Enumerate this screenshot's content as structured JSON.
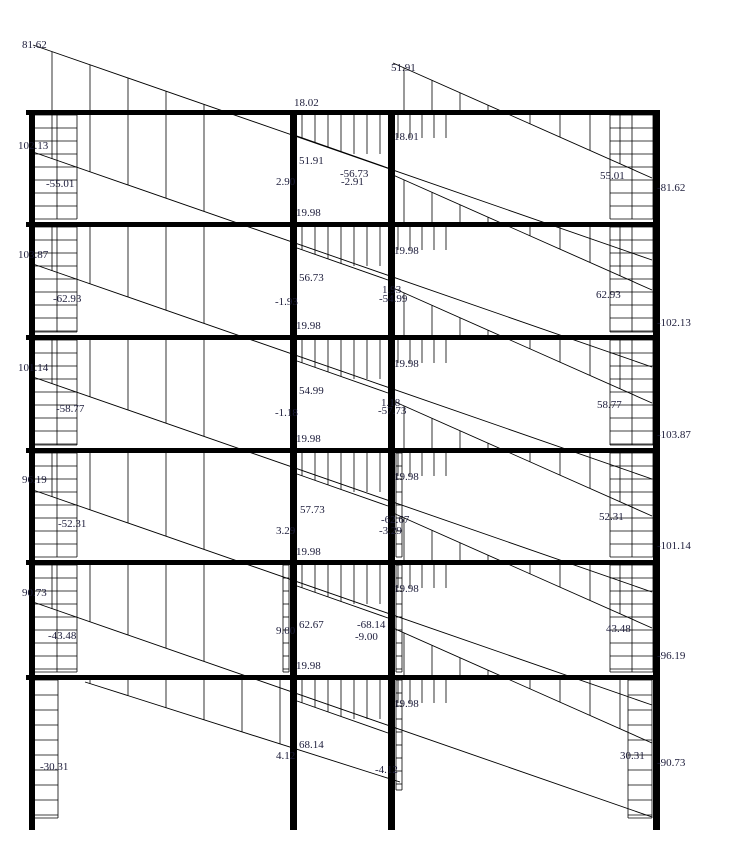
{
  "canvas": {
    "width": 729,
    "height": 867,
    "background": "#ffffff"
  },
  "colors": {
    "member": "#000000",
    "hatch": "#000000",
    "diagram_line": "#000000",
    "text": "#1c1c3a"
  },
  "figure_type": "frame-bending-moment-diagram",
  "frame": {
    "beams": {
      "ys": [
        110,
        222,
        335,
        448,
        560,
        675
      ],
      "x0": 26,
      "x1": 660,
      "thickness": 5
    },
    "columns": {
      "xs": [
        29,
        290,
        388,
        653
      ],
      "widths": [
        6,
        7,
        7,
        7
      ],
      "y0": 110,
      "y1": 830
    }
  },
  "story_tops": [
    110,
    222,
    335,
    448,
    560,
    675
  ],
  "diagram_lines": [
    {
      "id": "D0",
      "x0": 33,
      "y0": 45,
      "x1": 652,
      "y1": 260
    },
    {
      "id": "D1",
      "x0": 33,
      "y0": 152,
      "x1": 652,
      "y1": 367
    },
    {
      "id": "D2",
      "x0": 33,
      "y0": 264,
      "x1": 652,
      "y1": 479
    },
    {
      "id": "D3",
      "x0": 33,
      "y0": 377,
      "x1": 652,
      "y1": 592
    },
    {
      "id": "D4",
      "x0": 33,
      "y0": 490,
      "x1": 652,
      "y1": 705
    },
    {
      "id": "D5",
      "x0": 33,
      "y0": 602,
      "x1": 652,
      "y1": 817
    },
    {
      "id": "D6",
      "x0": 85,
      "y0": 682,
      "x1": 400,
      "y1": 782
    },
    {
      "id": "R1",
      "x0": 393,
      "y0": 63,
      "x1": 652,
      "y1": 178
    },
    {
      "id": "R2",
      "x0": 393,
      "y0": 175,
      "x1": 652,
      "y1": 290
    },
    {
      "id": "R3",
      "x0": 393,
      "y0": 288,
      "x1": 652,
      "y1": 403
    },
    {
      "id": "R4",
      "x0": 393,
      "y0": 401,
      "x1": 652,
      "y1": 516
    },
    {
      "id": "R5",
      "x0": 393,
      "y0": 513,
      "x1": 652,
      "y1": 628
    },
    {
      "id": "R6",
      "x0": 393,
      "y0": 628,
      "x1": 652,
      "y1": 743
    },
    {
      "id": "M1",
      "x0": 297,
      "y0": 136,
      "x1": 388,
      "y1": 168
    },
    {
      "id": "M2",
      "x0": 297,
      "y0": 248,
      "x1": 388,
      "y1": 280
    },
    {
      "id": "M3",
      "x0": 297,
      "y0": 361,
      "x1": 388,
      "y1": 393
    },
    {
      "id": "M4",
      "x0": 297,
      "y0": 474,
      "x1": 388,
      "y1": 506
    },
    {
      "id": "M5",
      "x0": 297,
      "y0": 586,
      "x1": 388,
      "y1": 618
    },
    {
      "id": "M6",
      "x0": 297,
      "y0": 701,
      "x1": 388,
      "y1": 733
    }
  ],
  "fan_singles": [
    {
      "x0": 52,
      "x1": 218,
      "step": 38,
      "base": 110,
      "line": "D0"
    },
    {
      "x0": 90,
      "x1": 280,
      "step": 38,
      "base": 680,
      "line": "D6"
    }
  ],
  "fan_specs": [
    {
      "x0": 52,
      "x1": 218,
      "step": 38,
      "off": 4,
      "line": "D",
      "stories": [
        1,
        2,
        3,
        4,
        5
      ]
    },
    {
      "x0": 404,
      "x1": 488,
      "step": 28,
      "off": 1,
      "line": "R",
      "stories": [
        1,
        2,
        3,
        4,
        5,
        6
      ]
    },
    {
      "x0": 530,
      "x1": 620,
      "step": 30,
      "off": 4,
      "line": "R",
      "stories": [
        1,
        2,
        3,
        4,
        5,
        6
      ]
    },
    {
      "x0": 352,
      "x1": 384,
      "step": 8,
      "off": 1,
      "line": "R",
      "maxLen": 16,
      "stories": [
        1,
        2,
        3,
        4,
        5,
        6
      ]
    },
    {
      "x0": 398,
      "x1": 446,
      "step": 12,
      "off": 4,
      "line": "Dprev",
      "maxLen": 24,
      "stories": [
        1,
        2,
        3,
        4,
        5,
        6
      ]
    },
    {
      "x0": 302,
      "x1": 380,
      "step": 13,
      "off": 4,
      "line": "M",
      "maxLen": 40,
      "stories": [
        1,
        2,
        3,
        4,
        5,
        6
      ]
    }
  ],
  "hatch_blocks": [
    {
      "x": 33,
      "w": 44,
      "y": 115,
      "h": 104,
      "rows": 13,
      "div": 57
    },
    {
      "x": 33,
      "w": 44,
      "y": 227,
      "h": 105,
      "rows": 13,
      "div": 57
    },
    {
      "x": 33,
      "w": 44,
      "y": 340,
      "h": 105,
      "rows": 13,
      "div": 57
    },
    {
      "x": 33,
      "w": 44,
      "y": 453,
      "h": 104,
      "rows": 13,
      "div": 57
    },
    {
      "x": 33,
      "w": 44,
      "y": 565,
      "h": 107,
      "rows": 13,
      "div": 57
    },
    {
      "x": 33,
      "w": 25,
      "y": 680,
      "h": 138,
      "rows": 15
    },
    {
      "x": 610,
      "w": 43,
      "y": 115,
      "h": 104,
      "rows": 13,
      "div": 632
    },
    {
      "x": 610,
      "w": 43,
      "y": 227,
      "h": 105,
      "rows": 13,
      "div": 632
    },
    {
      "x": 610,
      "w": 43,
      "y": 340,
      "h": 105,
      "rows": 13,
      "div": 632
    },
    {
      "x": 610,
      "w": 43,
      "y": 453,
      "h": 104,
      "rows": 13,
      "div": 632
    },
    {
      "x": 610,
      "w": 43,
      "y": 565,
      "h": 107,
      "rows": 13,
      "div": 632
    },
    {
      "x": 628,
      "w": 24,
      "y": 680,
      "h": 138,
      "rows": 15
    },
    {
      "x": 396,
      "w": 6,
      "y": 453,
      "h": 104,
      "rows": 13
    },
    {
      "x": 396,
      "w": 6,
      "y": 565,
      "h": 107,
      "rows": 13
    },
    {
      "x": 396,
      "w": 6,
      "y": 680,
      "h": 110,
      "rows": 13
    },
    {
      "x": 283,
      "w": 6,
      "y": 565,
      "h": 107,
      "rows": 13
    }
  ],
  "value_labels": [
    {
      "t": "81.62",
      "x": 22,
      "y": 39
    },
    {
      "t": "51.91",
      "x": 391,
      "y": 62
    },
    {
      "t": "18.02",
      "x": 294,
      "y": 97
    },
    {
      "t": "102.13",
      "x": 18,
      "y": 140
    },
    {
      "t": "-55.01",
      "x": 46,
      "y": 178
    },
    {
      "t": "51.91",
      "x": 299,
      "y": 155
    },
    {
      "t": "2.90",
      "x": 276,
      "y": 176
    },
    {
      "t": "-56.73",
      "x": 340,
      "y": 168
    },
    {
      "t": "-2.91",
      "x": 341,
      "y": 176
    },
    {
      "t": "18.01",
      "x": 394,
      "y": 131
    },
    {
      "t": "19.98",
      "x": 296,
      "y": 207
    },
    {
      "t": "55.01",
      "x": 600,
      "y": 170
    },
    {
      "t": "-81.62",
      "x": 657,
      "y": 182
    },
    {
      "t": "103.87",
      "x": 18,
      "y": 249
    },
    {
      "t": "-62.93",
      "x": 53,
      "y": 293
    },
    {
      "t": "19.98",
      "x": 394,
      "y": 245
    },
    {
      "t": "56.73",
      "x": 299,
      "y": 272
    },
    {
      "t": "-1.93",
      "x": 275,
      "y": 296
    },
    {
      "t": "1.93",
      "x": 382,
      "y": 284
    },
    {
      "t": "-54.99",
      "x": 379,
      "y": 293
    },
    {
      "t": "19.98",
      "x": 296,
      "y": 320
    },
    {
      "t": "62.93",
      "x": 596,
      "y": 289
    },
    {
      "t": "-102.13",
      "x": 657,
      "y": 317
    },
    {
      "t": "101.14",
      "x": 18,
      "y": 362
    },
    {
      "t": "-58.77",
      "x": 56,
      "y": 403
    },
    {
      "t": "19.98",
      "x": 394,
      "y": 358
    },
    {
      "t": "54.99",
      "x": 299,
      "y": 385
    },
    {
      "t": "-1.18",
      "x": 275,
      "y": 407
    },
    {
      "t": "1.18",
      "x": 381,
      "y": 397
    },
    {
      "t": "-57.73",
      "x": 378,
      "y": 405
    },
    {
      "t": "19.98",
      "x": 296,
      "y": 433
    },
    {
      "t": "58.77",
      "x": 597,
      "y": 399
    },
    {
      "t": "-103.87",
      "x": 657,
      "y": 429
    },
    {
      "t": "96.19",
      "x": 22,
      "y": 474
    },
    {
      "t": "-52.31",
      "x": 58,
      "y": 518
    },
    {
      "t": "19.98",
      "x": 394,
      "y": 471
    },
    {
      "t": "57.73",
      "x": 300,
      "y": 504
    },
    {
      "t": "3.29",
      "x": 276,
      "y": 525
    },
    {
      "t": "-62.67",
      "x": 381,
      "y": 514
    },
    {
      "t": "-3.29",
      "x": 379,
      "y": 525
    },
    {
      "t": "19.98",
      "x": 296,
      "y": 546
    },
    {
      "t": "52.31",
      "x": 599,
      "y": 511
    },
    {
      "t": "-101.14",
      "x": 657,
      "y": 540
    },
    {
      "t": "90.73",
      "x": 22,
      "y": 587
    },
    {
      "t": "-43.48",
      "x": 48,
      "y": 630
    },
    {
      "t": "19.98",
      "x": 394,
      "y": 583
    },
    {
      "t": "62.67",
      "x": 299,
      "y": 619
    },
    {
      "t": "9.00",
      "x": 276,
      "y": 625
    },
    {
      "t": "-68.14",
      "x": 357,
      "y": 619
    },
    {
      "t": "-9.00",
      "x": 355,
      "y": 631
    },
    {
      "t": "19.98",
      "x": 296,
      "y": 660
    },
    {
      "t": "43.48",
      "x": 606,
      "y": 623
    },
    {
      "t": "-96.19",
      "x": 657,
      "y": 650
    },
    {
      "t": "-30.31",
      "x": 40,
      "y": 761
    },
    {
      "t": "19.98",
      "x": 394,
      "y": 698
    },
    {
      "t": "68.14",
      "x": 299,
      "y": 739
    },
    {
      "t": "4.12",
      "x": 276,
      "y": 750
    },
    {
      "t": "-4.12",
      "x": 375,
      "y": 764
    },
    {
      "t": "30.31",
      "x": 620,
      "y": 750
    },
    {
      "t": "-90.73",
      "x": 657,
      "y": 757
    }
  ]
}
